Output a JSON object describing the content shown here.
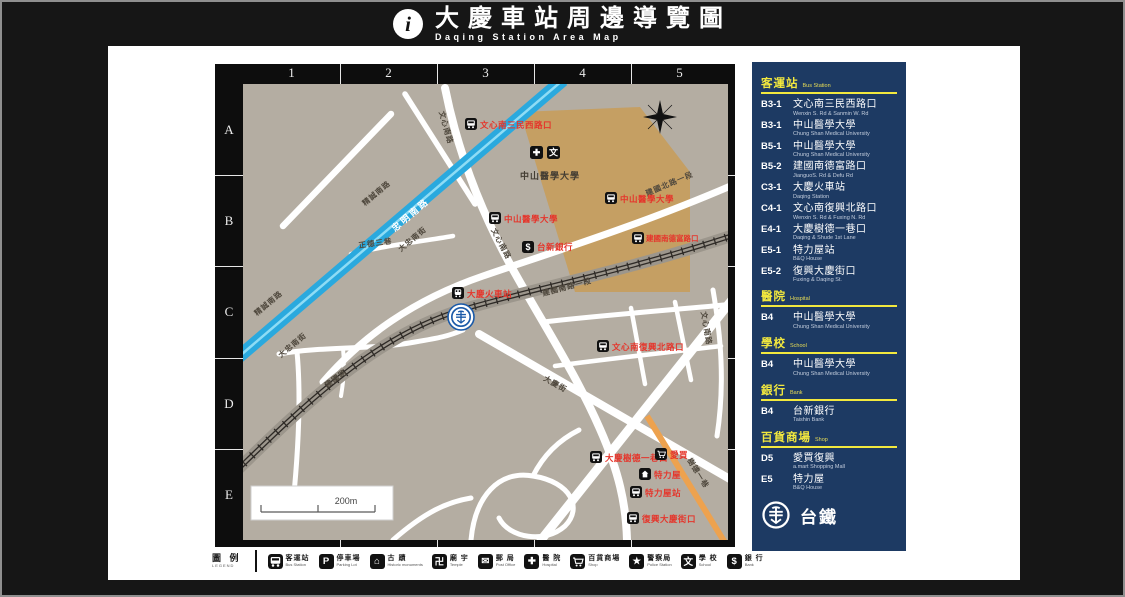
{
  "header": {
    "info_glyph": "i",
    "title": "大慶車站周邊導覽圖",
    "subtitle": "Daqing Station Area Map"
  },
  "map": {
    "grid_columns": [
      "1",
      "2",
      "3",
      "4",
      "5"
    ],
    "grid_rows": [
      "A",
      "B",
      "C",
      "D",
      "E"
    ],
    "scale_label": "200m",
    "campus": {
      "name": "中山醫學大學",
      "hospital_glyph": "✚",
      "school_glyph": "文"
    },
    "roads": {
      "zhongming": "忠明南路",
      "jingcheng": "精誠南路",
      "dazhong": "大忠南街",
      "wenxin": "文心南路",
      "jianguo_n": "建國北路一段",
      "jianguo_s": "建國南路一段",
      "jianguo": "建國路",
      "zhengde": "正德三巷",
      "daqing": "大慶街",
      "shude": "樹德一巷"
    },
    "pois": {
      "wenxin_sanmin": "文心南三民西路口",
      "csmu_b3": "中山醫學大學",
      "csmu_b5": "中山醫學大學",
      "jianguo_defu": "建國南德富路口",
      "taishin": "台新銀行",
      "taishin_glyph": "$",
      "daqing_station": "大慶火車站",
      "wenxin_fuxing": "文心南復興北路口",
      "daqing_shude": "大慶樹德一巷口",
      "amart": "愛買",
      "bnq": "特力屋",
      "bnq_stop": "特力屋站",
      "fuxing_daqing": "復興大慶街口"
    }
  },
  "sidebar": {
    "sections": [
      {
        "title": "客運站",
        "title_en": "Bus Station",
        "entries": [
          {
            "code": "B3-1",
            "name": "文心南三民西路口",
            "name_en": "Wenxin S. Rd & Sanmin W. Rd"
          },
          {
            "code": "B3-1",
            "name": "中山醫學大學",
            "name_en": "Chung Shan Medical University"
          },
          {
            "code": "B5-1",
            "name": "中山醫學大學",
            "name_en": "Chung Shan Medical University"
          },
          {
            "code": "B5-2",
            "name": "建國南德富路口",
            "name_en": "JianguoS. Rd & Defu Rd"
          },
          {
            "code": "C3-1",
            "name": "大慶火車站",
            "name_en": "Daqing Station"
          },
          {
            "code": "C4-1",
            "name": "文心南復興北路口",
            "name_en": "Wenxin S. Rd & Fuxing N. Rd"
          },
          {
            "code": "E4-1",
            "name": "大慶樹德一巷口",
            "name_en": "Daqing & Shude 1st Lane"
          },
          {
            "code": "E5-1",
            "name": "特力屋站",
            "name_en": "B&Q House"
          },
          {
            "code": "E5-2",
            "name": "復興大慶街口",
            "name_en": "Fuxing & Daqing St."
          }
        ]
      },
      {
        "title": "醫院",
        "title_en": "Hospital",
        "entries": [
          {
            "code": "B4",
            "name": "中山醫學大學",
            "name_en": "Chung Shan Medical University"
          }
        ]
      },
      {
        "title": "學校",
        "title_en": "School",
        "entries": [
          {
            "code": "B4",
            "name": "中山醫學大學",
            "name_en": "Chung Shan Medical University"
          }
        ]
      },
      {
        "title": "銀行",
        "title_en": "Bank",
        "entries": [
          {
            "code": "B4",
            "name": "台新銀行",
            "name_en": "Taishin Bank"
          }
        ]
      },
      {
        "title": "百貨商場",
        "title_en": "Shop",
        "entries": [
          {
            "code": "D5",
            "name": "愛買復興",
            "name_en": "a.mart Shopping Mall"
          },
          {
            "code": "E5",
            "name": "特力屋",
            "name_en": "B&Q House"
          }
        ]
      }
    ],
    "logo_label": "台鐵"
  },
  "legend": {
    "title": "圖 例",
    "title_en": "LEGEND",
    "items": [
      {
        "icon": "bus",
        "label": "客運站",
        "label_en": "Bus Station"
      },
      {
        "icon": "parking",
        "label": "停車場",
        "label_en": "Parking Lot",
        "glyph": "P"
      },
      {
        "icon": "historic-site",
        "label": "古 蹟",
        "label_en": "Historic monuments",
        "glyph": "⌂"
      },
      {
        "icon": "temple",
        "label": "廟 宇",
        "label_en": "Temple",
        "glyph": "卍"
      },
      {
        "icon": "post-office",
        "label": "郵 局",
        "label_en": "Post Office",
        "glyph": "✉"
      },
      {
        "icon": "hospital",
        "label": "醫 院",
        "label_en": "Hospital",
        "glyph": "✚"
      },
      {
        "icon": "shop",
        "label": "百貨商場",
        "label_en": "Shop"
      },
      {
        "icon": "police",
        "label": "警察局",
        "label_en": "Police Station",
        "glyph": "★"
      },
      {
        "icon": "school",
        "label": "學 校",
        "label_en": "School",
        "glyph": "文"
      },
      {
        "icon": "bank",
        "label": "銀 行",
        "label_en": "Bank",
        "glyph": "$"
      }
    ]
  },
  "colors": {
    "panel_navy": "#1d3a63",
    "accent_yellow": "#f2e83e",
    "map_bg": "#b4ada2",
    "campus_tan": "#c59f63",
    "road_blue": "#2aa9de",
    "road_orange": "#eda24f",
    "poi_red": "#e5352b",
    "tra_blue": "#1b5aa8"
  }
}
